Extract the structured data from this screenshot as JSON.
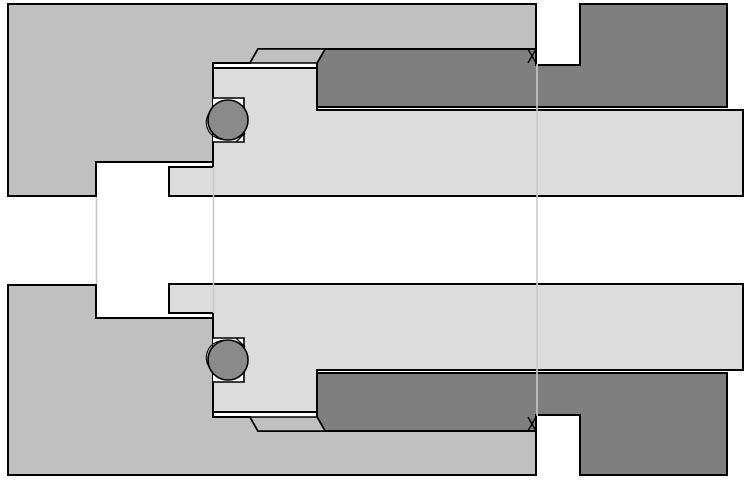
{
  "document": {
    "kind": "cad-cross-section-drawing",
    "description": "Axial cross-section of a threaded tube fitting assembly with O-ring seals, mirrored about the horizontal centerline"
  },
  "canvas": {
    "width": 750,
    "height": 480
  },
  "colors": {
    "background": "#ffffff",
    "port_body": "#c0c0c0",
    "male_fitting": "#7f7f7f",
    "sleeve": "#dcdcdc",
    "o_ring": "#8a8a8a",
    "outline": "#000000",
    "projection_line": "#c8c8c8"
  },
  "parts": [
    {
      "name": "port-body",
      "color_key": "port_body",
      "halves": [
        "upper",
        "lower"
      ]
    },
    {
      "name": "male-fitting",
      "color_key": "male_fitting",
      "halves": [
        "upper",
        "lower"
      ]
    },
    {
      "name": "sleeve",
      "color_key": "sleeve",
      "halves": [
        "upper",
        "lower"
      ]
    },
    {
      "name": "chamfer-collar",
      "color_key": "port_body",
      "halves": [
        "upper",
        "lower"
      ]
    },
    {
      "name": "o-ring",
      "color_key": "o_ring",
      "count": 2
    },
    {
      "name": "thread-section-mark",
      "symbol": "X",
      "count": 2
    },
    {
      "name": "projection-line",
      "count": 3
    }
  ]
}
